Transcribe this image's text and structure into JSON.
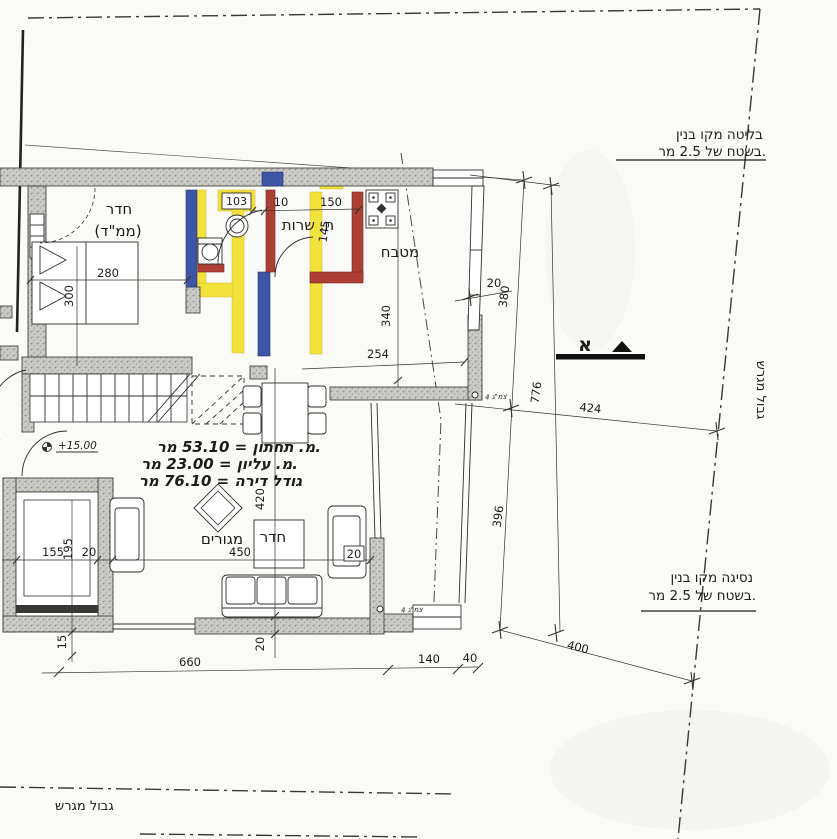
{
  "drawing": {
    "type": "architectural-floor-plan",
    "colors": {
      "highlight_yellow": "#f2e23b",
      "wall_blue": "#3d55a5",
      "wall_red": "#ad3f35",
      "wall_gray": "#cbcbc7",
      "paper": "#fafaf7"
    }
  },
  "notes": {
    "protrusion1": "בליטה מקו בנין",
    "protrusion2": "בשטח של 2.5 מר.",
    "setback1": "נסיגה מקו בנין",
    "setback2": "בשטח של 2.5 מר.",
    "boundary_right": "גבול מגרש",
    "boundary_bottom": "גבול מגרש",
    "section_letter": "א",
    "elevation": "+15.00",
    "pipe_upper": "צמ\"ג 4",
    "pipe_lower": "צמ\"ג 4"
  },
  "rooms": {
    "mamad1": "חדר",
    "mamad2": "(ממ\"ד)",
    "service": "ח. שרות",
    "kitchen": "מטבח",
    "living1": "חדר",
    "living2": "מגורים",
    "wc": "103"
  },
  "areas": {
    "lower": "מ. תחתון = 53.10 מר.",
    "upper": "מ. עליון = 23.00 מר.",
    "total": "גודל דירה = 76.10 מר"
  },
  "dims": {
    "bed_w": "280",
    "bed_h": "300",
    "d10": "10",
    "d150": "150",
    "d145": "145",
    "d340": "340",
    "d254": "254",
    "d420": "420",
    "d450": "450",
    "d20_sofa": "20",
    "d20_bottom": "20",
    "d20_top": "20",
    "shaft_w": "155",
    "shaft_h": "195",
    "shaft_t": "20",
    "d15": "15",
    "b660": "660",
    "b140": "140",
    "b40": "40",
    "r380": "380",
    "r776": "776",
    "r396": "396",
    "r424": "424",
    "r400": "400"
  }
}
